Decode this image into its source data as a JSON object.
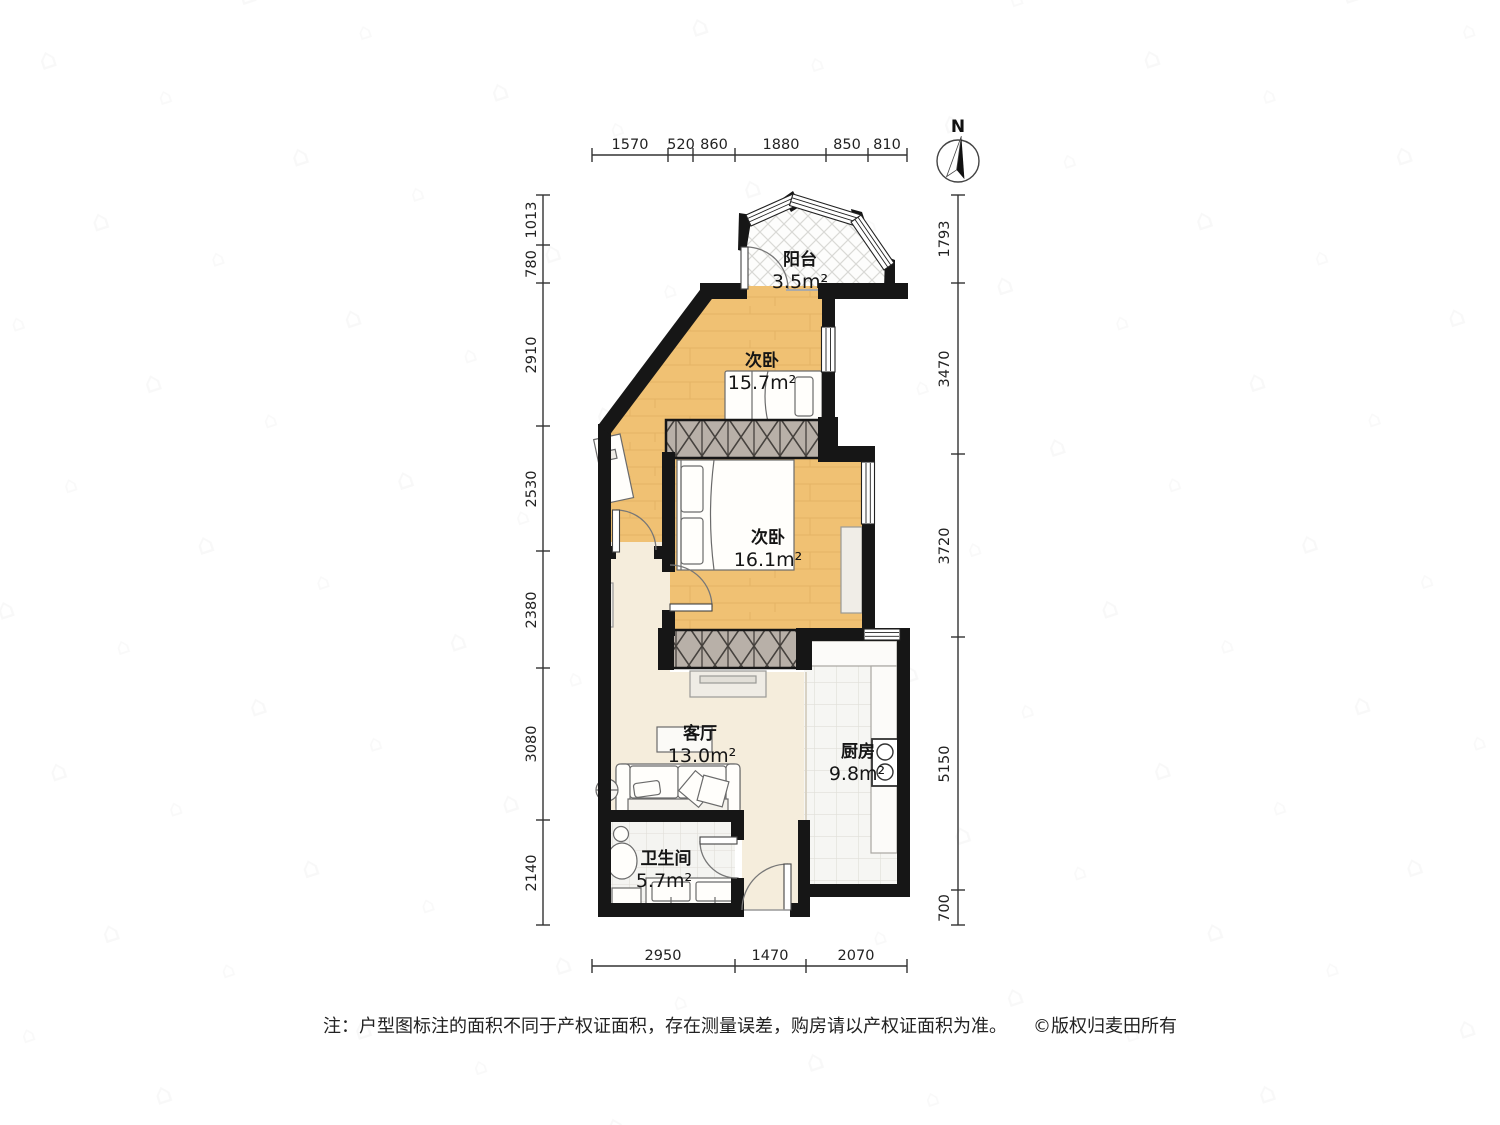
{
  "compass": {
    "label": "N"
  },
  "rooms": [
    {
      "id": "balcony",
      "name": "阳台",
      "area": "3.5m²"
    },
    {
      "id": "bedroom1",
      "name": "次卧",
      "area": "15.7m²"
    },
    {
      "id": "bedroom2",
      "name": "次卧",
      "area": "16.1m²"
    },
    {
      "id": "living",
      "name": "客厅",
      "area": "13.0m²"
    },
    {
      "id": "kitchen",
      "name": "厨房",
      "area": "9.8m²"
    },
    {
      "id": "bathroom",
      "name": "卫生间",
      "area": "5.7m²"
    }
  ],
  "dimensions": {
    "top": [
      "1570",
      "520",
      "860",
      "1880",
      "850",
      "810"
    ],
    "bottom": [
      "2950",
      "1470",
      "2070"
    ],
    "left": [
      "1013",
      "780",
      "2910",
      "2530",
      "2380",
      "3080",
      "2140"
    ],
    "right": [
      "1793",
      "3470",
      "3720",
      "5150",
      "700"
    ]
  },
  "footer": {
    "note": "注：户型图标注的面积不同于产权证面积，存在测量误差，购房请以产权证面积为准。",
    "copyright": "©版权归麦田所有"
  },
  "colors": {
    "wall": "#161616",
    "wood_floor": "#F0C173",
    "living_floor": "#F5EDDC",
    "tile_floor": "#F6F6F3",
    "wardrobe": "#B8B0A8"
  }
}
